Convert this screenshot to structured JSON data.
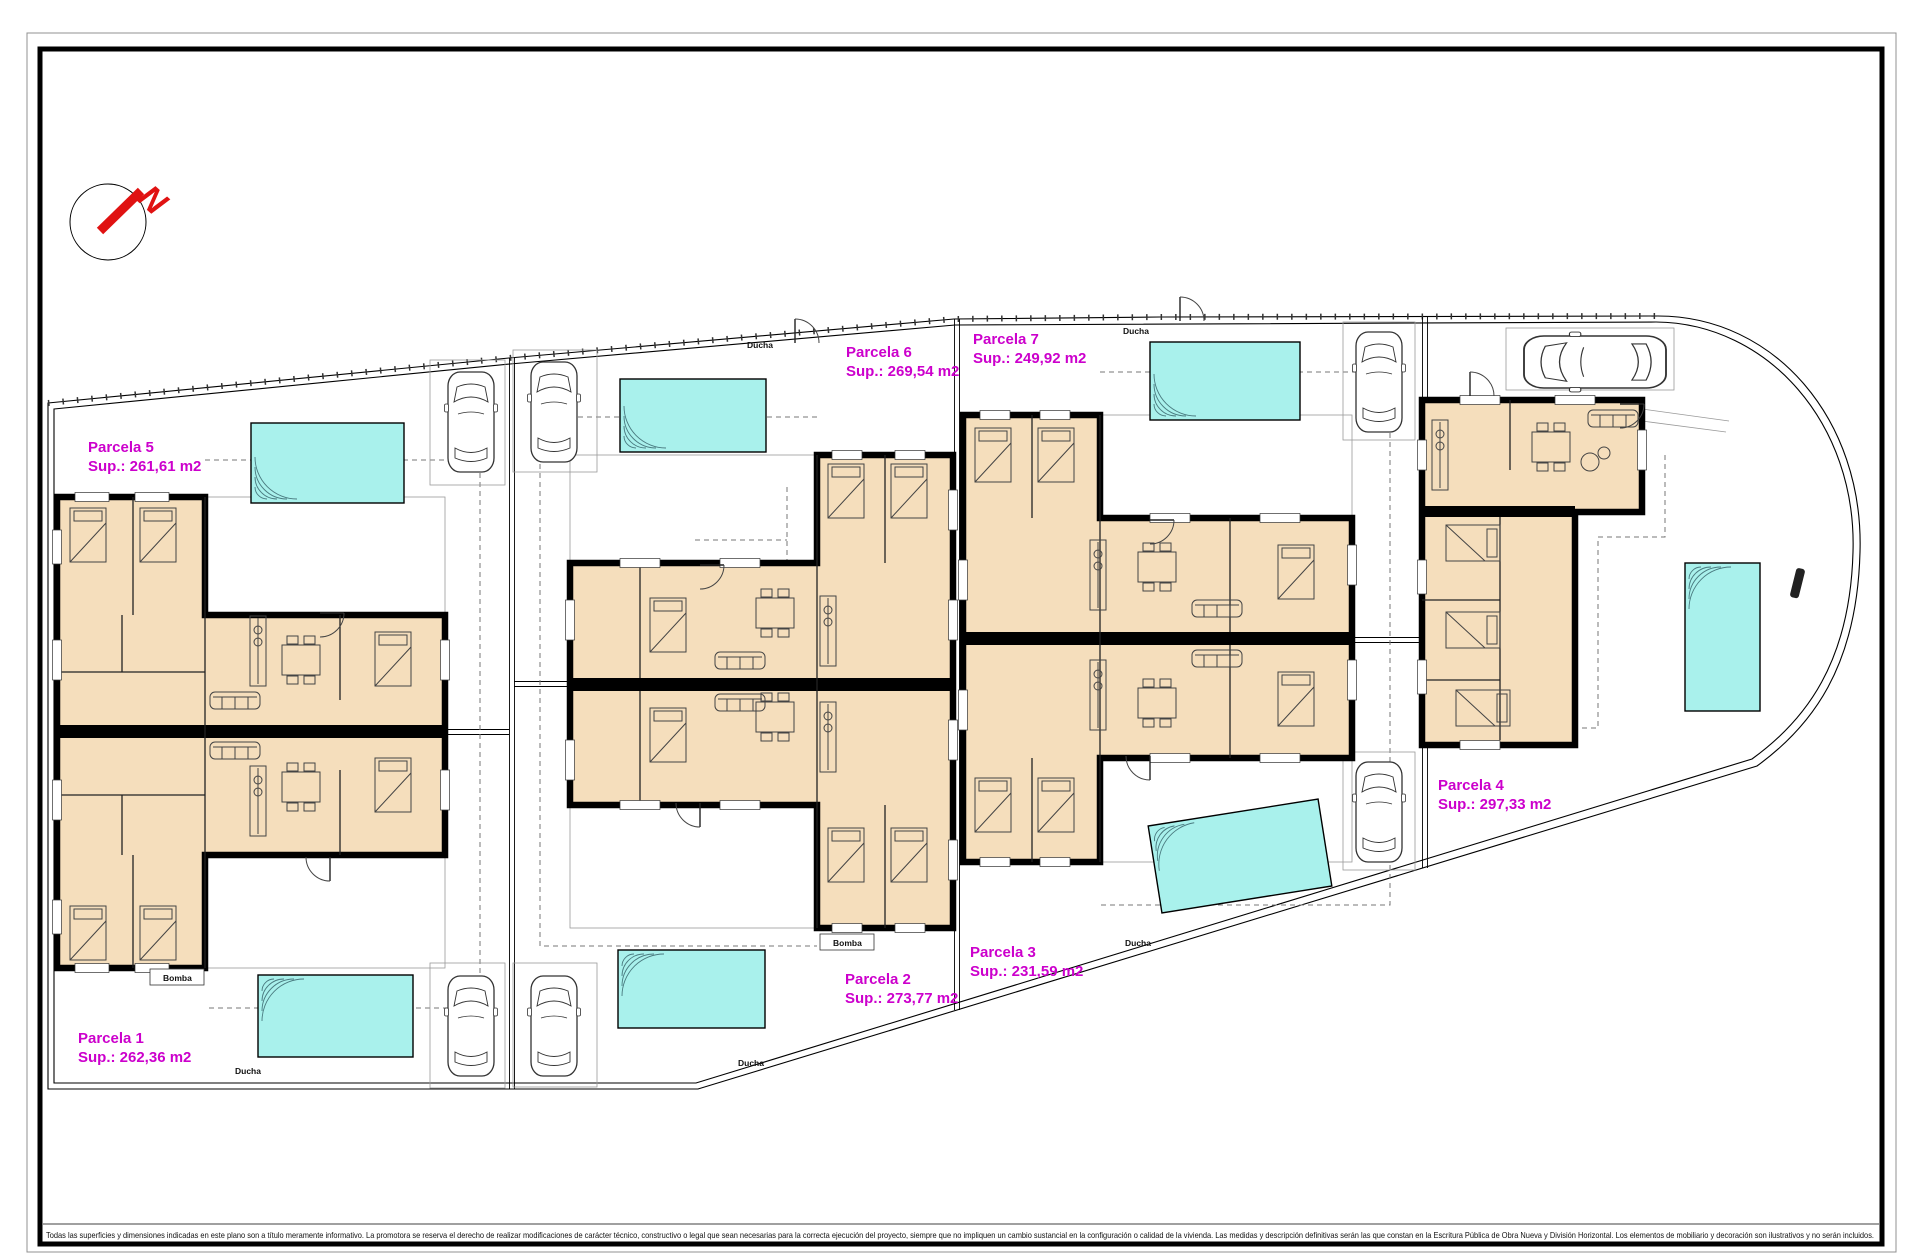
{
  "north": {
    "label": "N"
  },
  "parcels": {
    "p1": {
      "name": "Parcela 1",
      "sup": "Sup.: 262,36 m2"
    },
    "p2": {
      "name": "Parcela 2",
      "sup": "Sup.: 273,77 m2"
    },
    "p3": {
      "name": "Parcela 3",
      "sup": "Sup.: 231,59 m2"
    },
    "p4": {
      "name": "Parcela 4",
      "sup": "Sup.: 297,33 m2"
    },
    "p5": {
      "name": "Parcela 5",
      "sup": "Sup.: 261,61 m2"
    },
    "p6": {
      "name": "Parcela 6",
      "sup": "Sup.: 269,54 m2"
    },
    "p7": {
      "name": "Parcela 7",
      "sup": "Sup.: 249,92 m2"
    }
  },
  "annotations": {
    "shower": "Ducha",
    "pump": "Bomba"
  },
  "title_block": {
    "disclaimer": "Todas las superficies y dimensiones indicadas en este plano son a título meramente informativo. La promotora se reserva el derecho de realizar modificaciones de carácter técnico, constructivo o legal que sean necesarias para la correcta ejecución del proyecto, siempre que no impliquen un cambio sustancial en la configuración o calidad de la vivienda. Las medidas y descripción definitivas serán las que constan en la Escritura Pública de Obra Nueva y División Horizontal. Los elementos de mobiliario y decoración son ilustrativos y no serán incluidos."
  },
  "colors": {
    "room_fill": "#f5debc",
    "pool_fill": "#a9f1ec",
    "parcel_label": "#cc00cc",
    "north_red": "#e01212"
  }
}
